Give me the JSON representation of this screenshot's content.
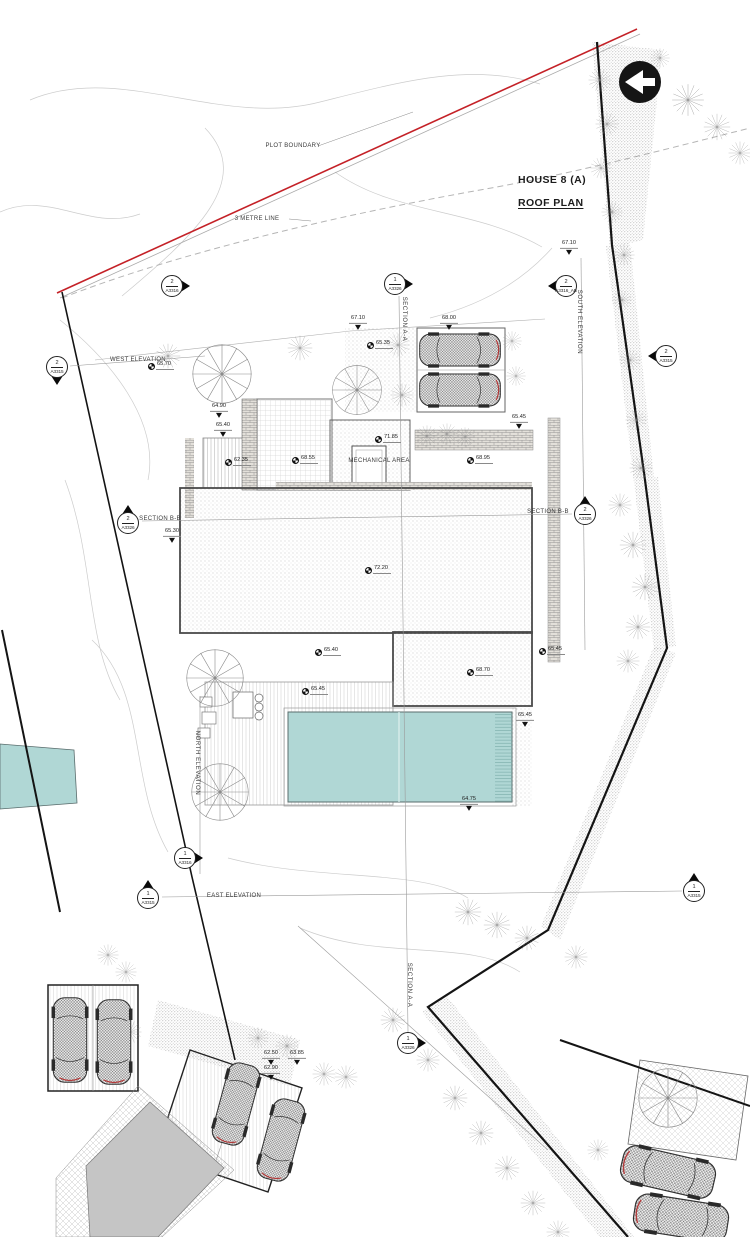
{
  "meta": {
    "width": 750,
    "height": 1237,
    "drawing_type": "architectural site / roof plan"
  },
  "title": {
    "house": "HOUSE 8 (A)",
    "plan": "ROOF PLAN"
  },
  "colors": {
    "paper": "#ffffff",
    "plot_boundary_red": "#c42127",
    "pool_teal": "#b0d7d5",
    "gray_area": "#c5c5c5",
    "ink": "#2a2a2a"
  },
  "labels": [
    {
      "text": "PLOT BOUNDARY",
      "x": 293,
      "y": 146,
      "rot": 0,
      "name": "plot-boundary-label"
    },
    {
      "text": "3 METRE LINE",
      "x": 257,
      "y": 219,
      "rot": 0,
      "name": "three-metre-line-label"
    },
    {
      "text": "WEST ELEVATION",
      "x": 138,
      "y": 360,
      "rot": 0,
      "name": "west-elevation-label"
    },
    {
      "text": "SOUTH ELEVATION",
      "x": 579,
      "y": 322,
      "rot": 90,
      "name": "south-elevation-label"
    },
    {
      "text": "SECTION A-A",
      "x": 404,
      "y": 319,
      "rot": 90,
      "name": "section-aa-label"
    },
    {
      "text": "SECTION B-B",
      "x": 160,
      "y": 519,
      "rot": 0,
      "name": "section-bb-label"
    },
    {
      "text": "SECTION B-B",
      "x": 548,
      "y": 512,
      "rot": 0,
      "name": "section-bb-label"
    },
    {
      "text": "NORTH ELEVATION",
      "x": 197,
      "y": 763,
      "rot": 90,
      "name": "north-elevation-label"
    },
    {
      "text": "EAST ELEVATION",
      "x": 234,
      "y": 896,
      "rot": 0,
      "name": "east-elevation-label"
    },
    {
      "text": "SECTION A-A",
      "x": 409,
      "y": 985,
      "rot": 90,
      "name": "section-aa-label"
    },
    {
      "text": "MECHANICAL AREA",
      "x": 379,
      "y": 461,
      "rot": 0,
      "name": "mechanical-area-label"
    }
  ],
  "spot_levels": [
    {
      "value": "67.10",
      "x": 569,
      "y": 247,
      "symbol": "tri"
    },
    {
      "value": "67.10",
      "x": 358,
      "y": 322,
      "symbol": "tri"
    },
    {
      "value": "68.00",
      "x": 449,
      "y": 322,
      "symbol": "tri"
    },
    {
      "value": "65.35",
      "x": 371,
      "y": 346,
      "symbol": "pin"
    },
    {
      "value": "65.70",
      "x": 152,
      "y": 367,
      "symbol": "pin"
    },
    {
      "value": "64.90",
      "x": 219,
      "y": 410,
      "symbol": "tri"
    },
    {
      "value": "65.40",
      "x": 223,
      "y": 429,
      "symbol": "tri"
    },
    {
      "value": "62.35",
      "x": 229,
      "y": 463,
      "symbol": "pin"
    },
    {
      "value": "68.55",
      "x": 296,
      "y": 461,
      "symbol": "pin"
    },
    {
      "value": "71.85",
      "x": 379,
      "y": 440,
      "symbol": "pin"
    },
    {
      "value": "68.95",
      "x": 471,
      "y": 461,
      "symbol": "pin"
    },
    {
      "value": "65.45",
      "x": 519,
      "y": 421,
      "symbol": "tri"
    },
    {
      "value": "65.30",
      "x": 172,
      "y": 535,
      "symbol": "tri"
    },
    {
      "value": "72.20",
      "x": 369,
      "y": 571,
      "symbol": "pin"
    },
    {
      "value": "65.40",
      "x": 319,
      "y": 653,
      "symbol": "pin"
    },
    {
      "value": "65.45",
      "x": 306,
      "y": 692,
      "symbol": "pin"
    },
    {
      "value": "68.70",
      "x": 471,
      "y": 673,
      "symbol": "pin"
    },
    {
      "value": "65.45",
      "x": 543,
      "y": 652,
      "symbol": "pin"
    },
    {
      "value": "65.45",
      "x": 525,
      "y": 719,
      "symbol": "tri"
    },
    {
      "value": "64.75",
      "x": 469,
      "y": 803,
      "symbol": "tri"
    },
    {
      "value": "62.50",
      "x": 271,
      "y": 1057,
      "symbol": "tri"
    },
    {
      "value": "63.85",
      "x": 297,
      "y": 1057,
      "symbol": "tri"
    },
    {
      "value": "62.90",
      "x": 271,
      "y": 1072,
      "symbol": "tri"
    }
  ],
  "markers": [
    {
      "num": "2",
      "sheet": "A3316",
      "x": 172,
      "y": 286,
      "tri": "right"
    },
    {
      "num": "1",
      "sheet": "A3326",
      "x": 395,
      "y": 284,
      "tri": "right"
    },
    {
      "num": "2",
      "sheet": "A3316_AB",
      "x": 566,
      "y": 286,
      "tri": "left"
    },
    {
      "num": "2",
      "sheet": "A3315",
      "x": 57,
      "y": 367,
      "tri": "down"
    },
    {
      "num": "2",
      "sheet": "A3315",
      "x": 666,
      "y": 356,
      "tri": "left"
    },
    {
      "num": "2",
      "sheet": "A3326",
      "x": 128,
      "y": 523,
      "tri": "up"
    },
    {
      "num": "2",
      "sheet": "A3326",
      "x": 585,
      "y": 514,
      "tri": "up"
    },
    {
      "num": "1",
      "sheet": "A3316",
      "x": 185,
      "y": 858,
      "tri": "right"
    },
    {
      "num": "1",
      "sheet": "A3315",
      "x": 148,
      "y": 898,
      "tri": "up"
    },
    {
      "num": "1",
      "sheet": "A3315",
      "x": 694,
      "y": 891,
      "tri": "up"
    },
    {
      "num": "1",
      "sheet": "A3326",
      "x": 408,
      "y": 1043,
      "tri": "right"
    }
  ]
}
